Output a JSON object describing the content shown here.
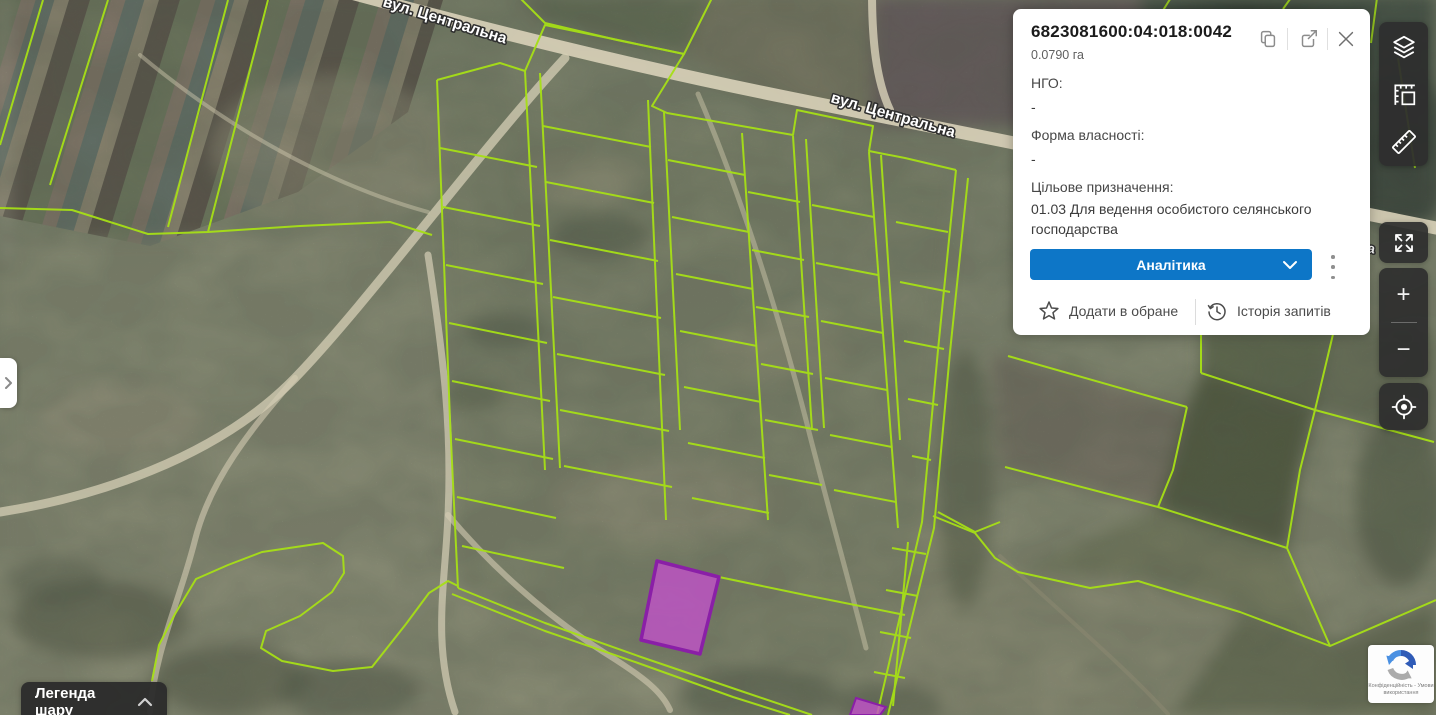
{
  "map": {
    "street_label": "вул. Центральна",
    "street_label_cut": "а",
    "parcel_outline_color": "#a6df16",
    "selected_parcel_fill": "#c351cc",
    "selected_parcel_border": "#8a1fa7"
  },
  "info_panel": {
    "parcel_id": "6823081600:04:018:0042",
    "area": "0.0790 га",
    "ngo_label": "НГО:",
    "ngo_value": "-",
    "ownership_label": "Форма власності:",
    "ownership_value": "-",
    "purpose_label": "Цільове призначення:",
    "purpose_value": "01.03 Для ведення особистого селянського господарства",
    "analytics_label": "Аналітика",
    "favorites_label": "Додати в обране",
    "history_label": "Історія запитів",
    "accent_color": "#0d76c7"
  },
  "controls": {
    "zoom_in": "+",
    "zoom_out": "−",
    "legend_label": "Легенда шару"
  },
  "recaptcha": {
    "line1": "Конфіденційність - Умови",
    "line2": "використання"
  }
}
